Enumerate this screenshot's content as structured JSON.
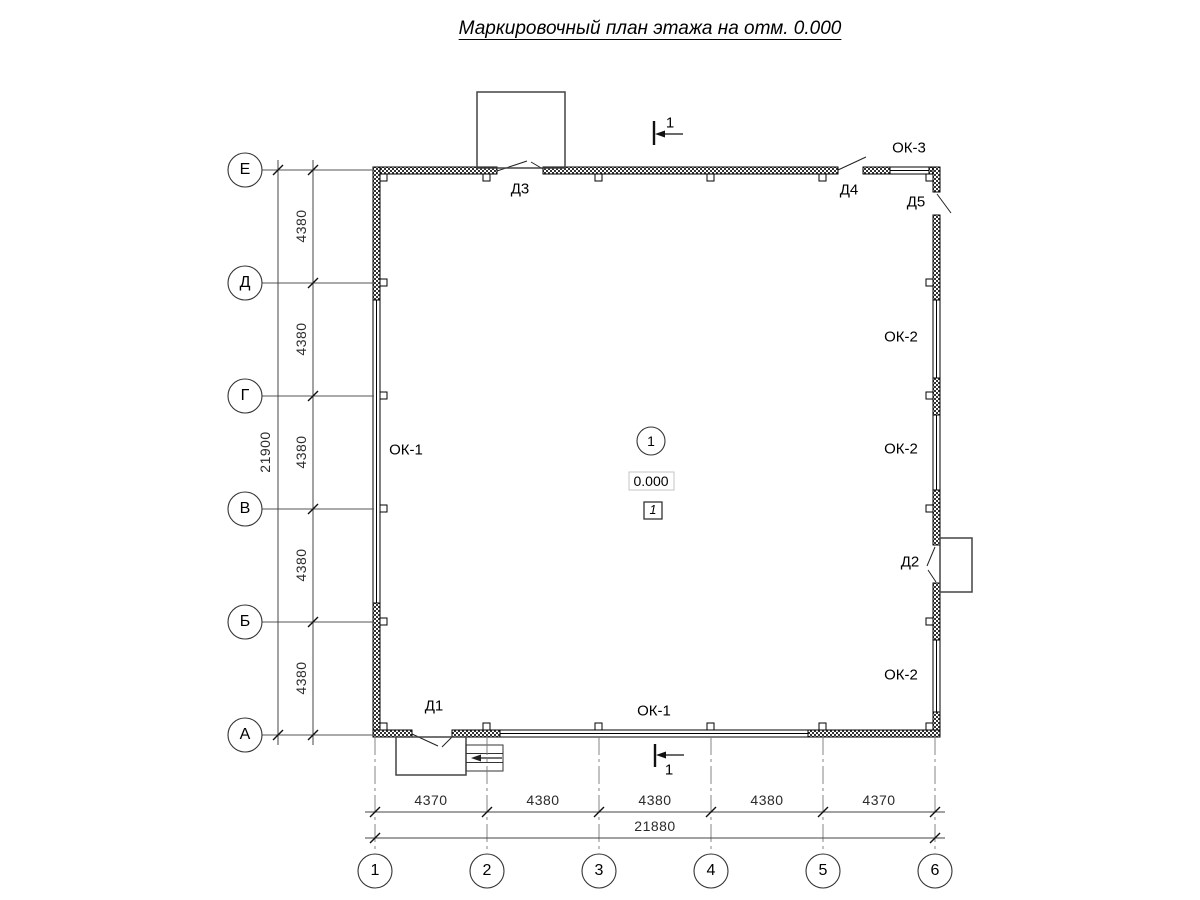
{
  "title": "Маркировочный план этажа на отм. 0.000",
  "axes": {
    "rows": [
      {
        "label": "Е"
      },
      {
        "label": "Д"
      },
      {
        "label": "Г"
      },
      {
        "label": "В"
      },
      {
        "label": "Б"
      },
      {
        "label": "А"
      }
    ],
    "cols": [
      {
        "label": "1"
      },
      {
        "label": "2"
      },
      {
        "label": "3"
      },
      {
        "label": "4"
      },
      {
        "label": "5"
      },
      {
        "label": "6"
      }
    ]
  },
  "dimensions": {
    "left_total": "21900",
    "left_segments": [
      "4380",
      "4380",
      "4380",
      "4380",
      "4380"
    ],
    "bottom_segments": [
      "4370",
      "4380",
      "4380",
      "4380",
      "4370"
    ],
    "bottom_total": "21880"
  },
  "windows": {
    "left": "ОК-1",
    "bottom": "ОК-1",
    "right_top": "ОК-2",
    "right_middle": "ОК-2",
    "right_bottom": "ОК-2",
    "top_right": "ОК-3"
  },
  "doors": {
    "d1": "Д1",
    "d2": "Д2",
    "d3": "Д3",
    "d4": "Д4",
    "d5": "Д5"
  },
  "room": {
    "number": "1",
    "elevation": "0.000",
    "zone_box": "1"
  },
  "section_marks": {
    "top": "1",
    "bottom": "1"
  }
}
